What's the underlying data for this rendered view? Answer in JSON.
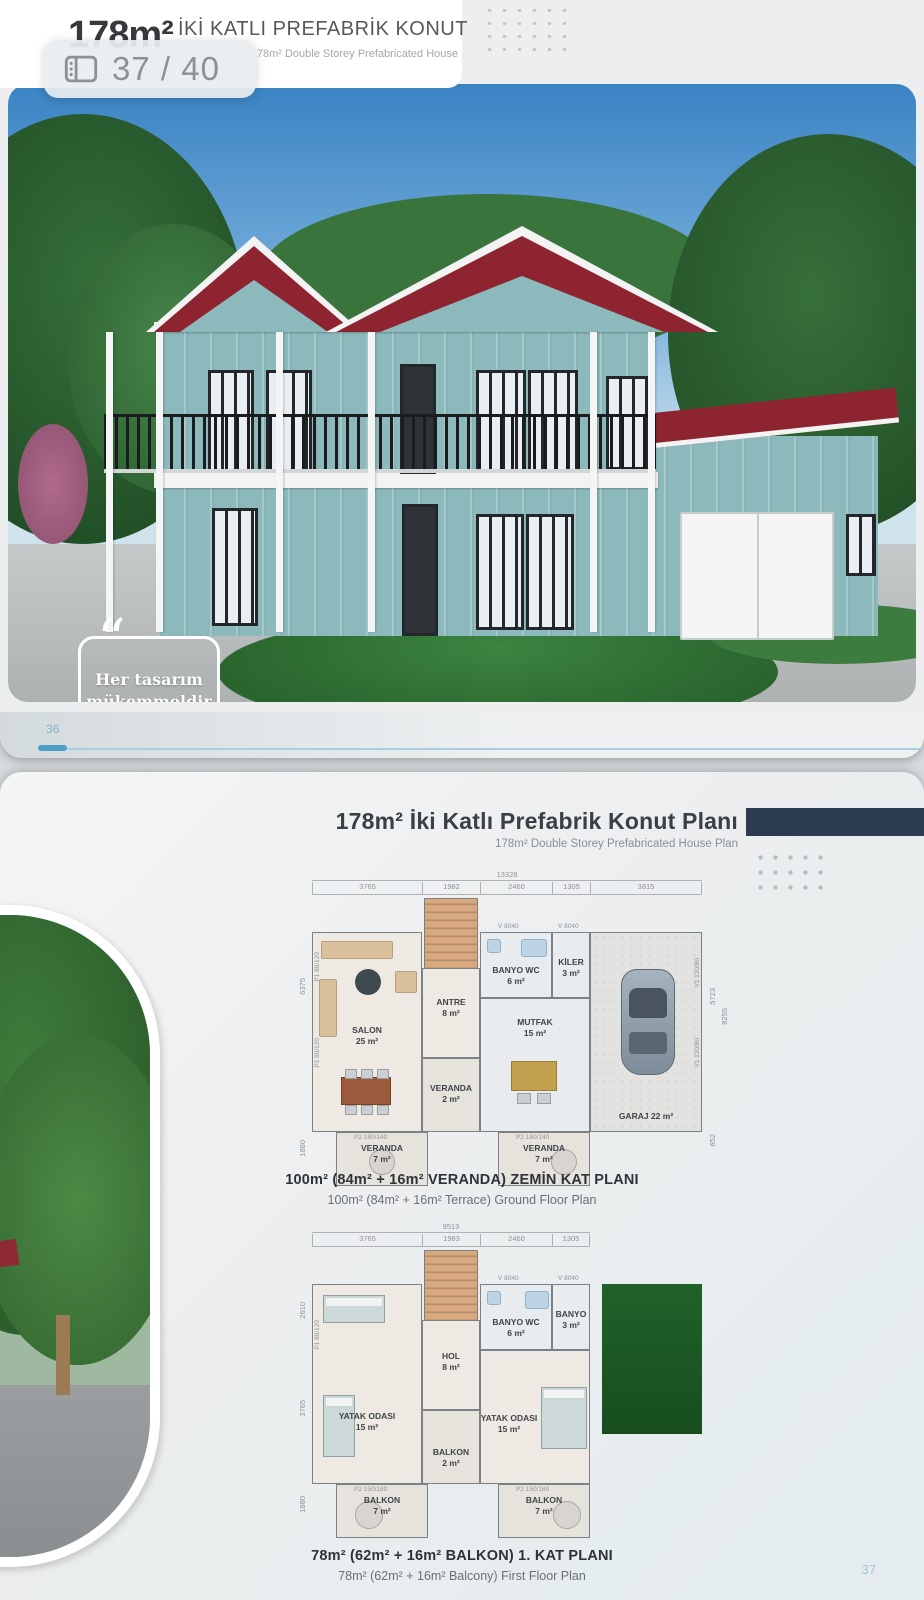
{
  "page1": {
    "header": {
      "area": "178m²",
      "title": "İKİ KATLI PREFABRİK KONUT",
      "subtitle": "178m² Double Storey Prefabricated House"
    },
    "pager": {
      "label": "37 / 40"
    },
    "quote": {
      "text_line1": "Her tasarım",
      "text_line2": "mükemmeldir",
      "open_mark": "“",
      "close_mark": "”"
    },
    "footer": {
      "page_number": "36"
    }
  },
  "page2": {
    "header": {
      "title": "178m² İki Katlı Prefabrik Konut Planı",
      "subtitle": "178m² Double Storey Prefabricated House Plan"
    },
    "ground_floor": {
      "total_width": "13328",
      "segments": [
        "3765",
        "1982",
        "2460",
        "1305",
        "3815"
      ],
      "left_dims": [
        "6375",
        "1880"
      ],
      "right_dims": [
        "5723",
        "8255",
        "652"
      ],
      "window_labels": {
        "top1": "V 8040",
        "top2": "V 8040",
        "left1": "P1 80/120",
        "left2": "P1 80/120",
        "right1": "V1 120/80",
        "right2": "V1 120/80",
        "bottom1": "P2 180/140",
        "bottom2": "P2 180/140"
      },
      "rooms": [
        {
          "name": "SALON",
          "area": "25 m²"
        },
        {
          "name": "ANTRE",
          "area": "8 m²"
        },
        {
          "name": "BANYO WC",
          "area": "6 m²"
        },
        {
          "name": "KİLER",
          "area": "3 m²"
        },
        {
          "name": "MUTFAK",
          "area": "15 m²"
        },
        {
          "name": "VERANDA",
          "area": "2 m²"
        },
        {
          "name": "VERANDA",
          "area": "7 m²"
        },
        {
          "name": "VERANDA",
          "area": "7 m²"
        },
        {
          "name": "GARAJ",
          "area": "22 m²"
        }
      ],
      "caption_tr": "100m²  (84m² + 16m²  VERANDA) ZEMİN KAT PLANI",
      "caption_en": "100m² (84m² + 16m² Terrace) Ground Floor Plan"
    },
    "first_floor": {
      "total_width": "9513",
      "segments": [
        "3765",
        "1983",
        "2460",
        "1305"
      ],
      "left_dims": [
        "2610",
        "3765",
        "1880"
      ],
      "window_labels": {
        "top1": "V 8040",
        "top2": "V 8040",
        "left1": "P1 80/120",
        "bottom1": "P2 150/180",
        "bottom2": "P2 150/180"
      },
      "rooms": [
        {
          "name": "YATAK ODASI",
          "area": "15 m²"
        },
        {
          "name": "HOL",
          "area": "8 m²"
        },
        {
          "name": "BANYO WC",
          "area": "6 m²"
        },
        {
          "name": "BANYO",
          "area": "3 m²"
        },
        {
          "name": "YATAK ODASI",
          "area": "15 m²"
        },
        {
          "name": "BALKON",
          "area": "2 m²"
        },
        {
          "name": "BALKON",
          "area": "7 m²"
        },
        {
          "name": "BALKON",
          "area": "7 m²"
        }
      ],
      "caption_tr": "78m²  (62m² + 16m²  BALKON) 1. KAT  PLANI",
      "caption_en": "78m² (62m² + 16m² Balcony) First Floor Plan"
    },
    "footer": {
      "page_number": "37"
    }
  }
}
